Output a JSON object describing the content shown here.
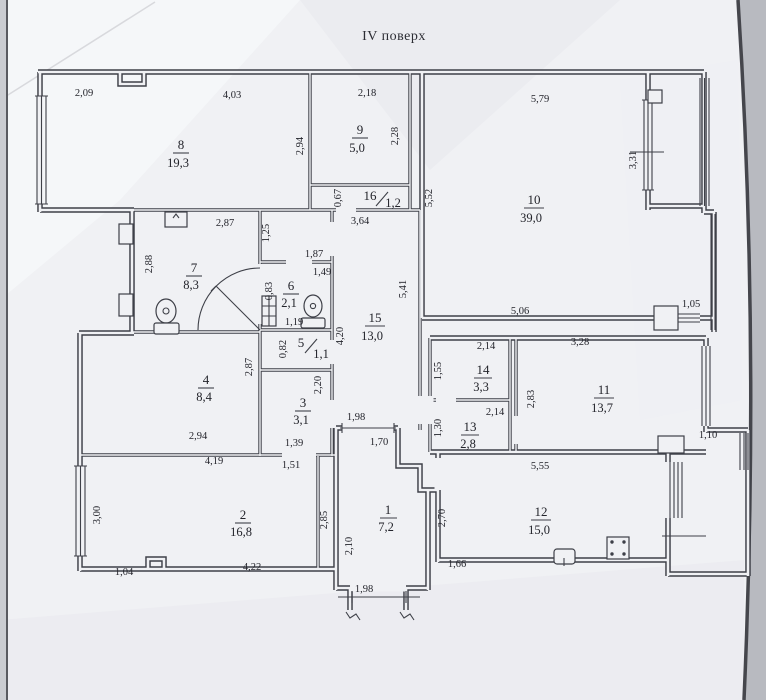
{
  "title": "IV поверх",
  "rooms": [
    {
      "number": "1",
      "area": "7,2"
    },
    {
      "number": "2",
      "area": "16,8"
    },
    {
      "number": "3",
      "area": "3,1"
    },
    {
      "number": "4",
      "area": "8,4"
    },
    {
      "number": "5",
      "area": "1,1"
    },
    {
      "number": "6",
      "area": "2,1"
    },
    {
      "number": "7",
      "area": "8,3"
    },
    {
      "number": "8",
      "area": "19,3"
    },
    {
      "number": "9",
      "area": "5,0"
    },
    {
      "number": "10",
      "area": "39,0"
    },
    {
      "number": "11",
      "area": "13,7"
    },
    {
      "number": "12",
      "area": "15,0"
    },
    {
      "number": "13",
      "area": "2,8"
    },
    {
      "number": "14",
      "area": "3,3"
    },
    {
      "number": "15",
      "area": "13,0"
    },
    {
      "number": "16",
      "area": "1,2"
    }
  ],
  "dims": [
    "2,09",
    "4,03",
    "2,18",
    "5,79",
    "2,94",
    "2,28",
    "3,31",
    "5,52",
    "0,67",
    "3,64",
    "2,87",
    "1,25",
    "2,88",
    "1,87",
    "1,49",
    "0,83",
    "1,19",
    "0,82",
    "4,20",
    "5,41",
    "5,06",
    "1,05",
    "2,87",
    "2,20",
    "2,14",
    "1,55",
    "3,28",
    "2,83",
    "2,14",
    "1,30",
    "1,98",
    "1,70",
    "2,94",
    "1,39",
    "1,51",
    "4,19",
    "3,00",
    "2,85",
    "2,10",
    "2,70",
    "5,55",
    "1,10",
    "1,04",
    "4,22",
    "1,66",
    "1,98"
  ],
  "colors": {
    "paper": "#f0f1f4",
    "ink": "#23242b",
    "wall": "#3e4048",
    "photo_edge": "#45464c",
    "backdrop": "#b8bac0"
  }
}
